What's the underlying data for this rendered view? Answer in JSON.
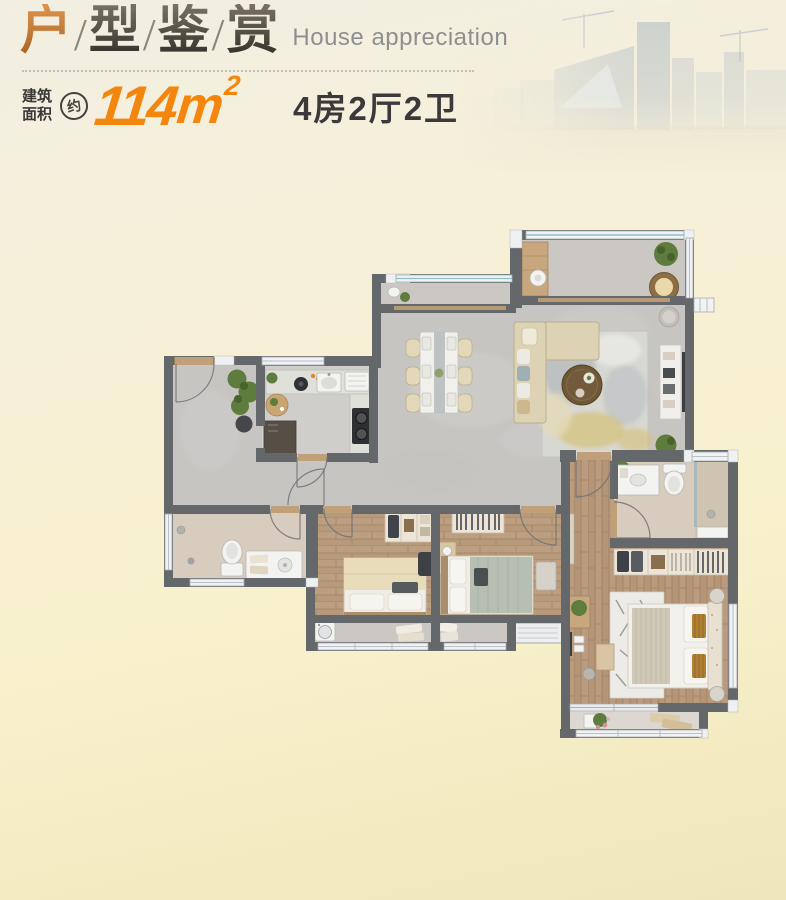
{
  "header": {
    "title_chars": [
      "户",
      "型",
      "鉴",
      "赏"
    ],
    "separator": "/",
    "subtitle": "House appreciation",
    "area_label": [
      "建筑",
      "面积"
    ],
    "approx_badge": "约",
    "area_value": "114",
    "area_unit": "m",
    "area_exponent": "2",
    "layout_text": "4房2厅2卫"
  },
  "colors": {
    "accent": "#f5860d",
    "title-accent-top": "#dd954e",
    "title-accent-bottom": "#a85c20",
    "title-dark-top": "#7a7264",
    "title-dark-bottom": "#2f2b27",
    "subtitle": "#8f8f91",
    "text-dark": "#3b393a",
    "slash": "#8b877e",
    "divider": "#c3bfb4",
    "wall": "#65686b",
    "tile": "#c7c5c2",
    "tile2": "#cbc8c3",
    "wood": "#b69878",
    "marble": "#d7ccbe",
    "bg-top": "#f2efe2",
    "bg-bottom": "#f0e6bb"
  }
}
